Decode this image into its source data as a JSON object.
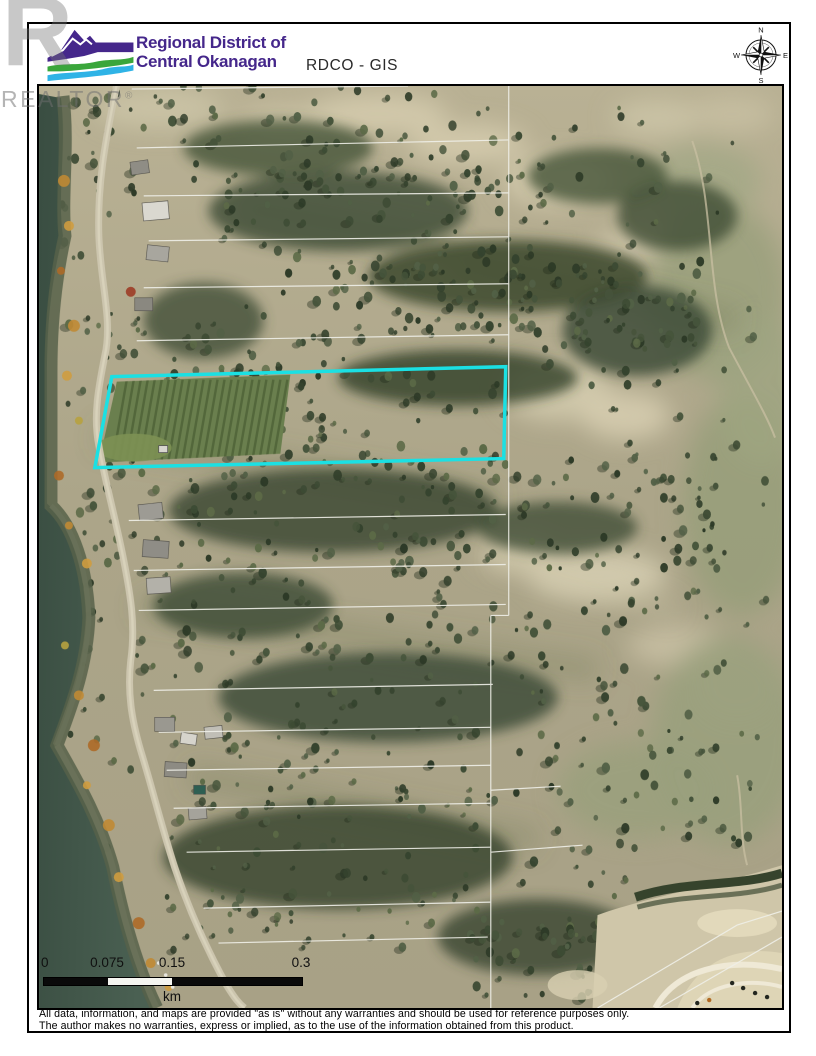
{
  "watermark": {
    "big_letter": "R",
    "label": "REALTOR",
    "registered": "®"
  },
  "header": {
    "logo_line1": "Regional District of",
    "logo_line2": "Central Okanagan",
    "title": "RDCO - GIS"
  },
  "compass": {
    "n": "N",
    "e": "E",
    "s": "S",
    "w": "W"
  },
  "map": {
    "description": "Aerial orthophoto with white cadastral parcel lines; subject parcel outlined in cyan; lake shoreline, road and houses along west edge",
    "highlight_color": "#1BE0E3",
    "parcel_line_color": "#EFEFE8"
  },
  "scale_bar": {
    "labels": [
      "0",
      "0.075",
      "0.15",
      "0.3"
    ],
    "unit": "km"
  },
  "disclaimer": {
    "line1": "All data, information, and maps are provided \"as is\" without any warranties and should be used for reference purposes only.",
    "line2": "The author makes no warranties, express or implied, as to the use of the information obtained from this product."
  },
  "colors": {
    "logo_purple": "#45278B",
    "logo_green": "#3AA63B",
    "logo_blue": "#2FB3E6",
    "water": "#41564A",
    "terrain": "#B0A88C",
    "forest": "#36442E",
    "sand": "#D5CCAF"
  }
}
